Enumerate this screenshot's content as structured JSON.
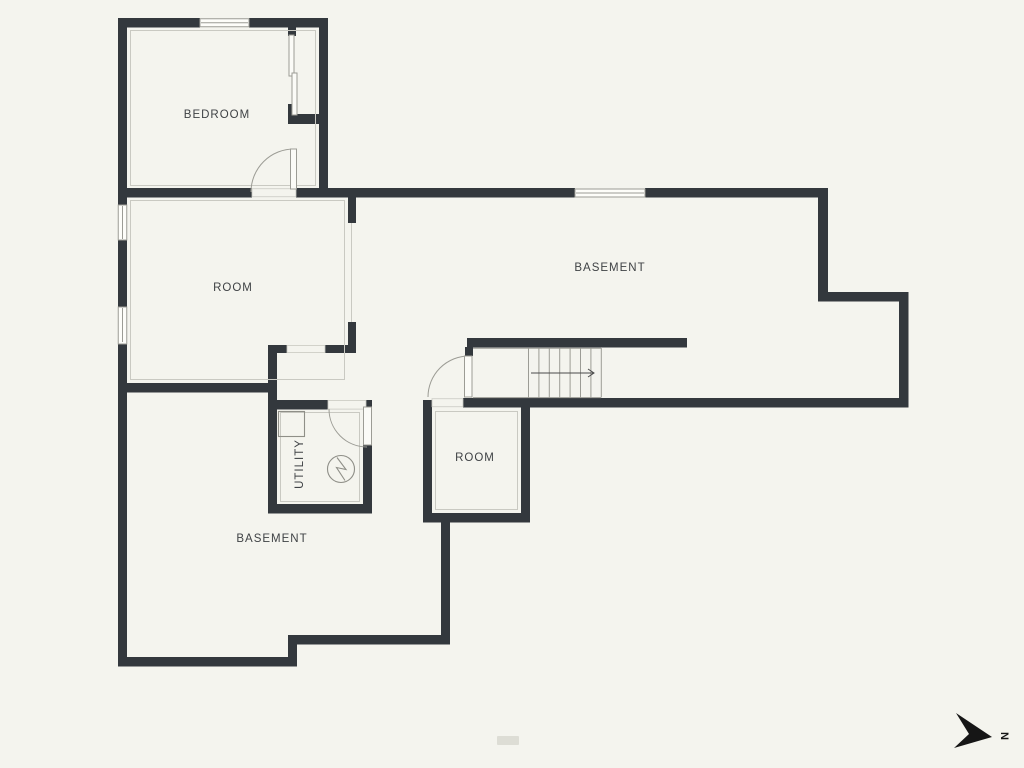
{
  "theme": {
    "background": "#f4f4ee",
    "wall_color": "#33383d",
    "line_color": "#9c9c95",
    "inset_color": "#c9c9c2",
    "text_color": "#3f4245",
    "door_fill": "#fbfbf7",
    "window_fill": "#fdfdf9",
    "compass_color": "#161616"
  },
  "floor_plan": {
    "rooms": [
      {
        "id": "bedroom",
        "label": "BEDROOM"
      },
      {
        "id": "room_left",
        "label": "ROOM"
      },
      {
        "id": "basement_upper",
        "label": "BASEMENT"
      },
      {
        "id": "utility",
        "label": "UTILITY"
      },
      {
        "id": "room_lower",
        "label": "ROOM"
      },
      {
        "id": "basement_lower",
        "label": "BASEMENT"
      }
    ],
    "features": [
      {
        "id": "stairs",
        "description": "staircase with direction arrow"
      },
      {
        "id": "water_heater",
        "description": "circle with lightning zigzag symbol in utility room"
      }
    ],
    "compass": {
      "label": "N"
    }
  }
}
